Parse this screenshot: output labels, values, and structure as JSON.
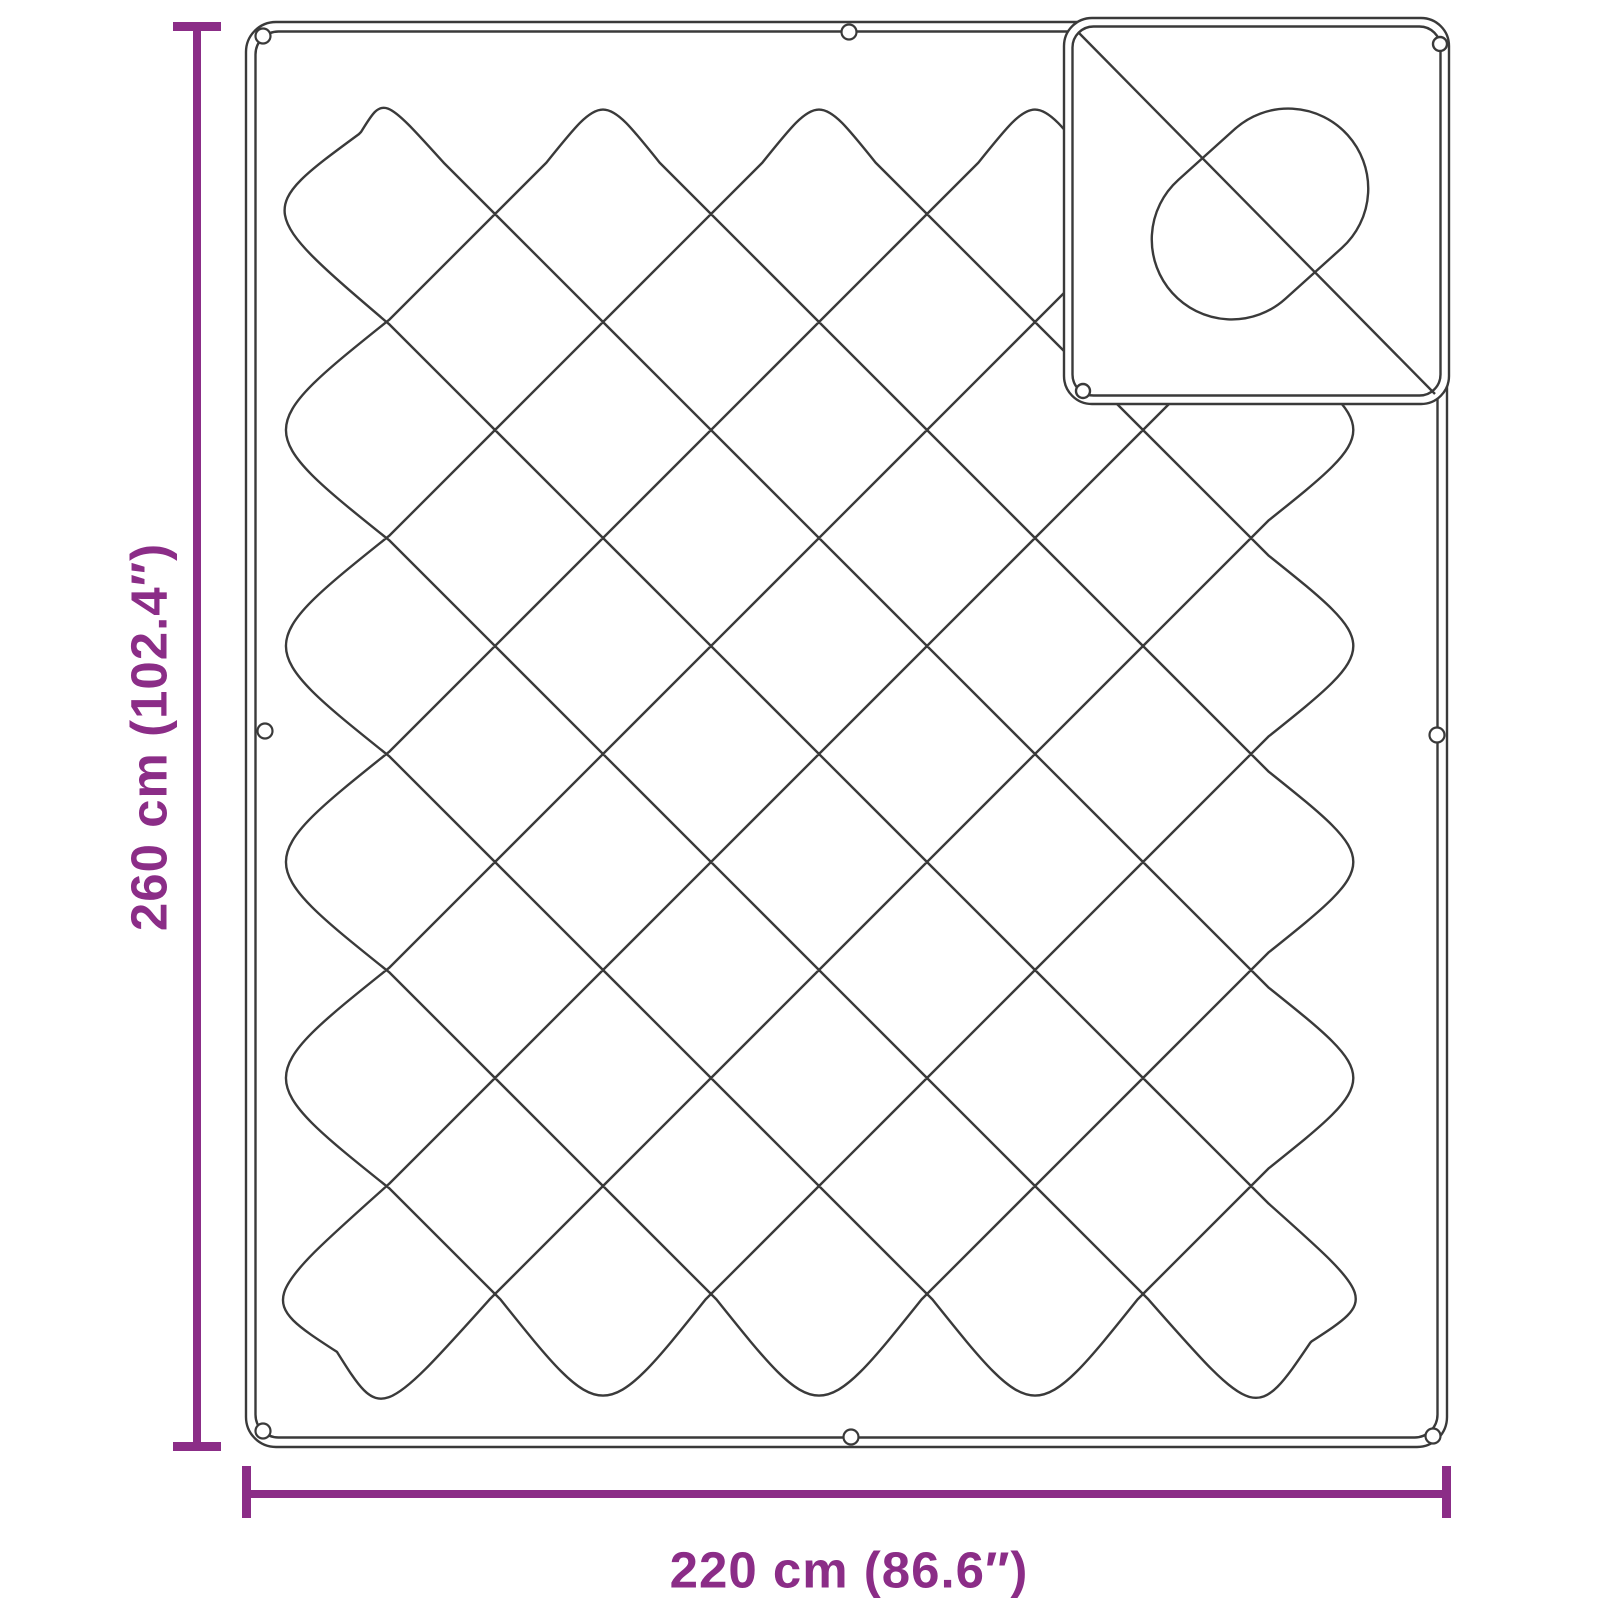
{
  "diagram": {
    "height_label": "260 cm (102.4″)",
    "width_label": "220 cm (86.6″)"
  },
  "dimensions": {
    "height_cm": 260,
    "height_in": 102.4,
    "width_cm": 220,
    "width_in": 86.6
  },
  "colors": {
    "accent": "#8b2d87",
    "line": "#3a3a3a",
    "background": "#ffffff"
  }
}
